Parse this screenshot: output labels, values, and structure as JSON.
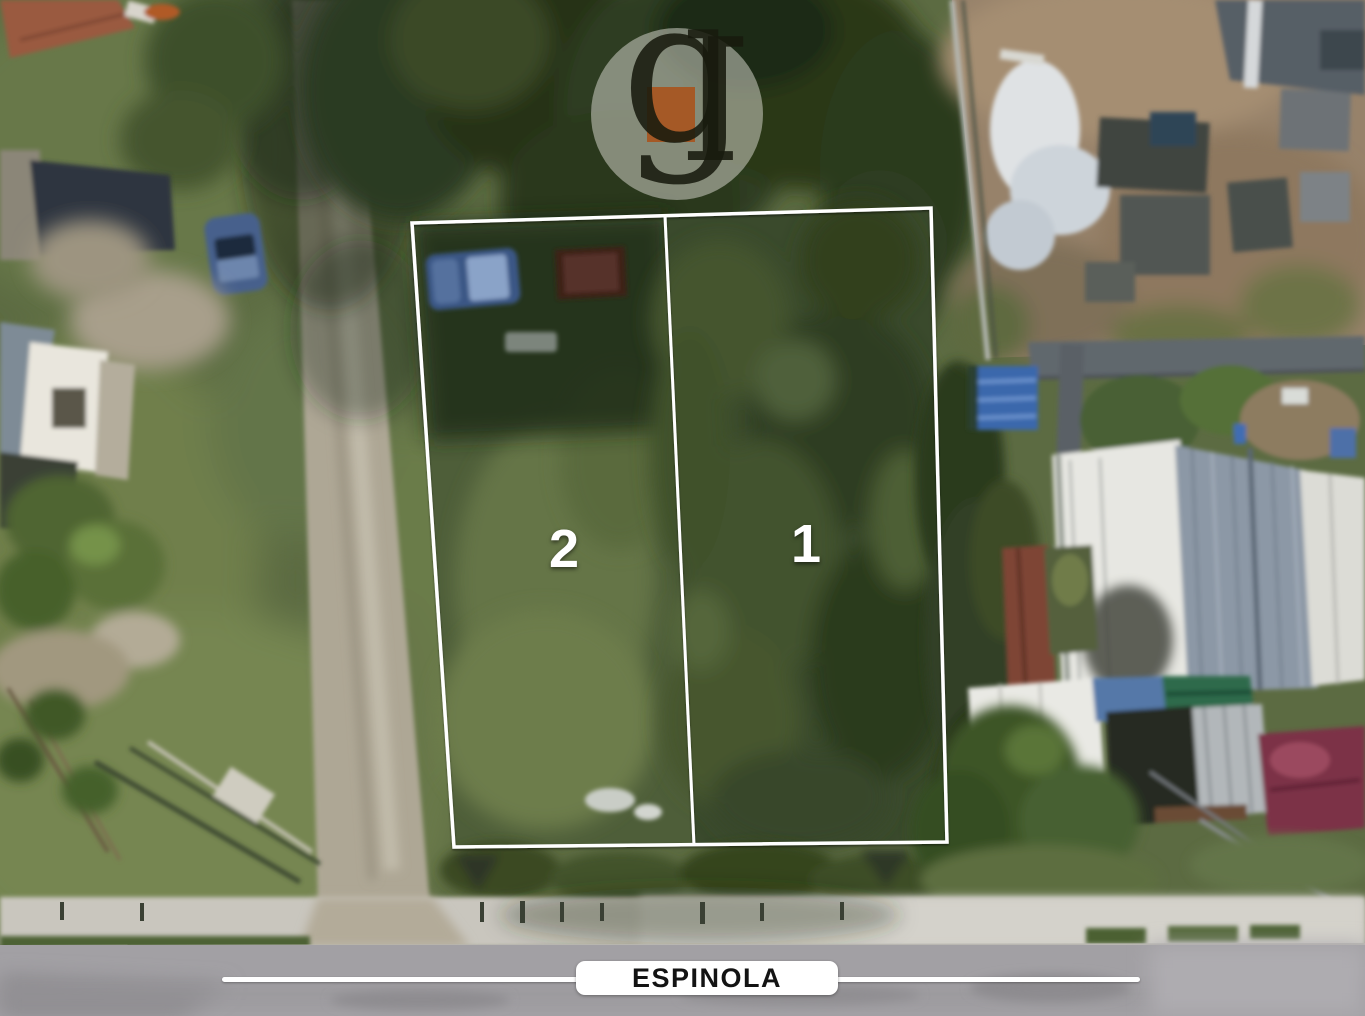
{
  "lots": [
    {
      "id": "lot-2",
      "label": "2"
    },
    {
      "id": "lot-1",
      "label": "1"
    }
  ],
  "street": {
    "name": "ESPINOLA"
  },
  "watermark": {
    "letter_g": "g",
    "letter_l": "l",
    "accent_color": "#a8531d"
  },
  "colors": {
    "lot_outline": "#ffffff",
    "lot_label_text": "#ffffff",
    "street_line": "#ffffff",
    "street_label_bg": "#ffffff",
    "street_label_text": "#131313"
  }
}
